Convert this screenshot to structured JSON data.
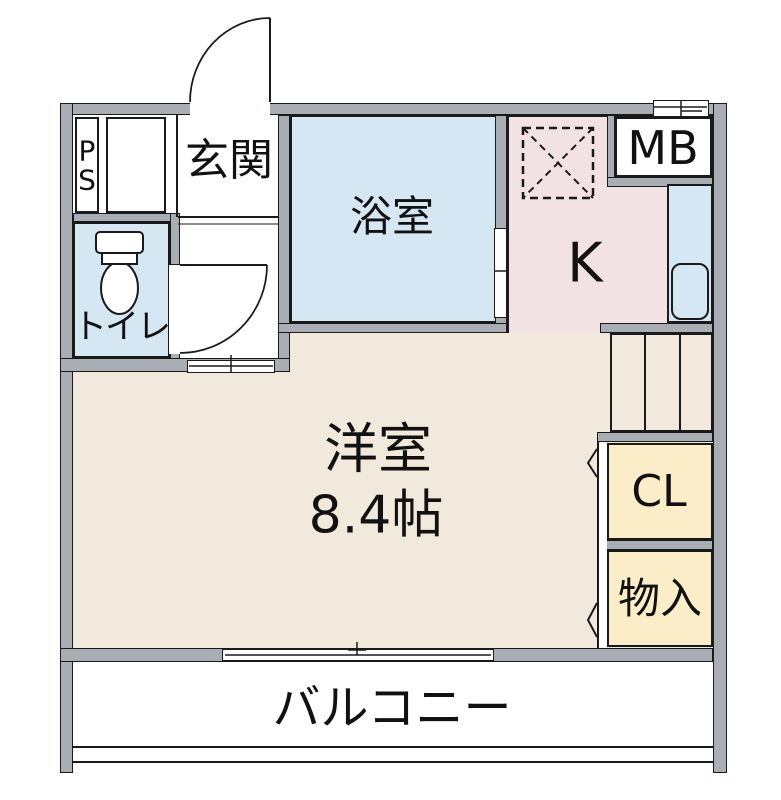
{
  "floorplan": {
    "title": "1R apartment floor plan",
    "rooms": {
      "ps": {
        "label": "P\nS"
      },
      "genkan": {
        "label": "玄関"
      },
      "toilet": {
        "label": "トイレ"
      },
      "bathroom": {
        "label": "浴室"
      },
      "kitchen": {
        "label": "K"
      },
      "meter_box": {
        "label": "MB"
      },
      "main_room": {
        "label": "洋室",
        "size": "8.4帖"
      },
      "closet": {
        "label": "CL"
      },
      "storage": {
        "label": "物入"
      },
      "balcony": {
        "label": "バルコニー"
      }
    },
    "colors": {
      "wall": "#a9aeb5",
      "line": "#1a1a1a",
      "room_beige": "#f1e9dc",
      "wet_area_blue": "#d6e7f4",
      "kitchen_pink": "#f2e2e3",
      "closet_cream": "#fcedc9"
    }
  }
}
